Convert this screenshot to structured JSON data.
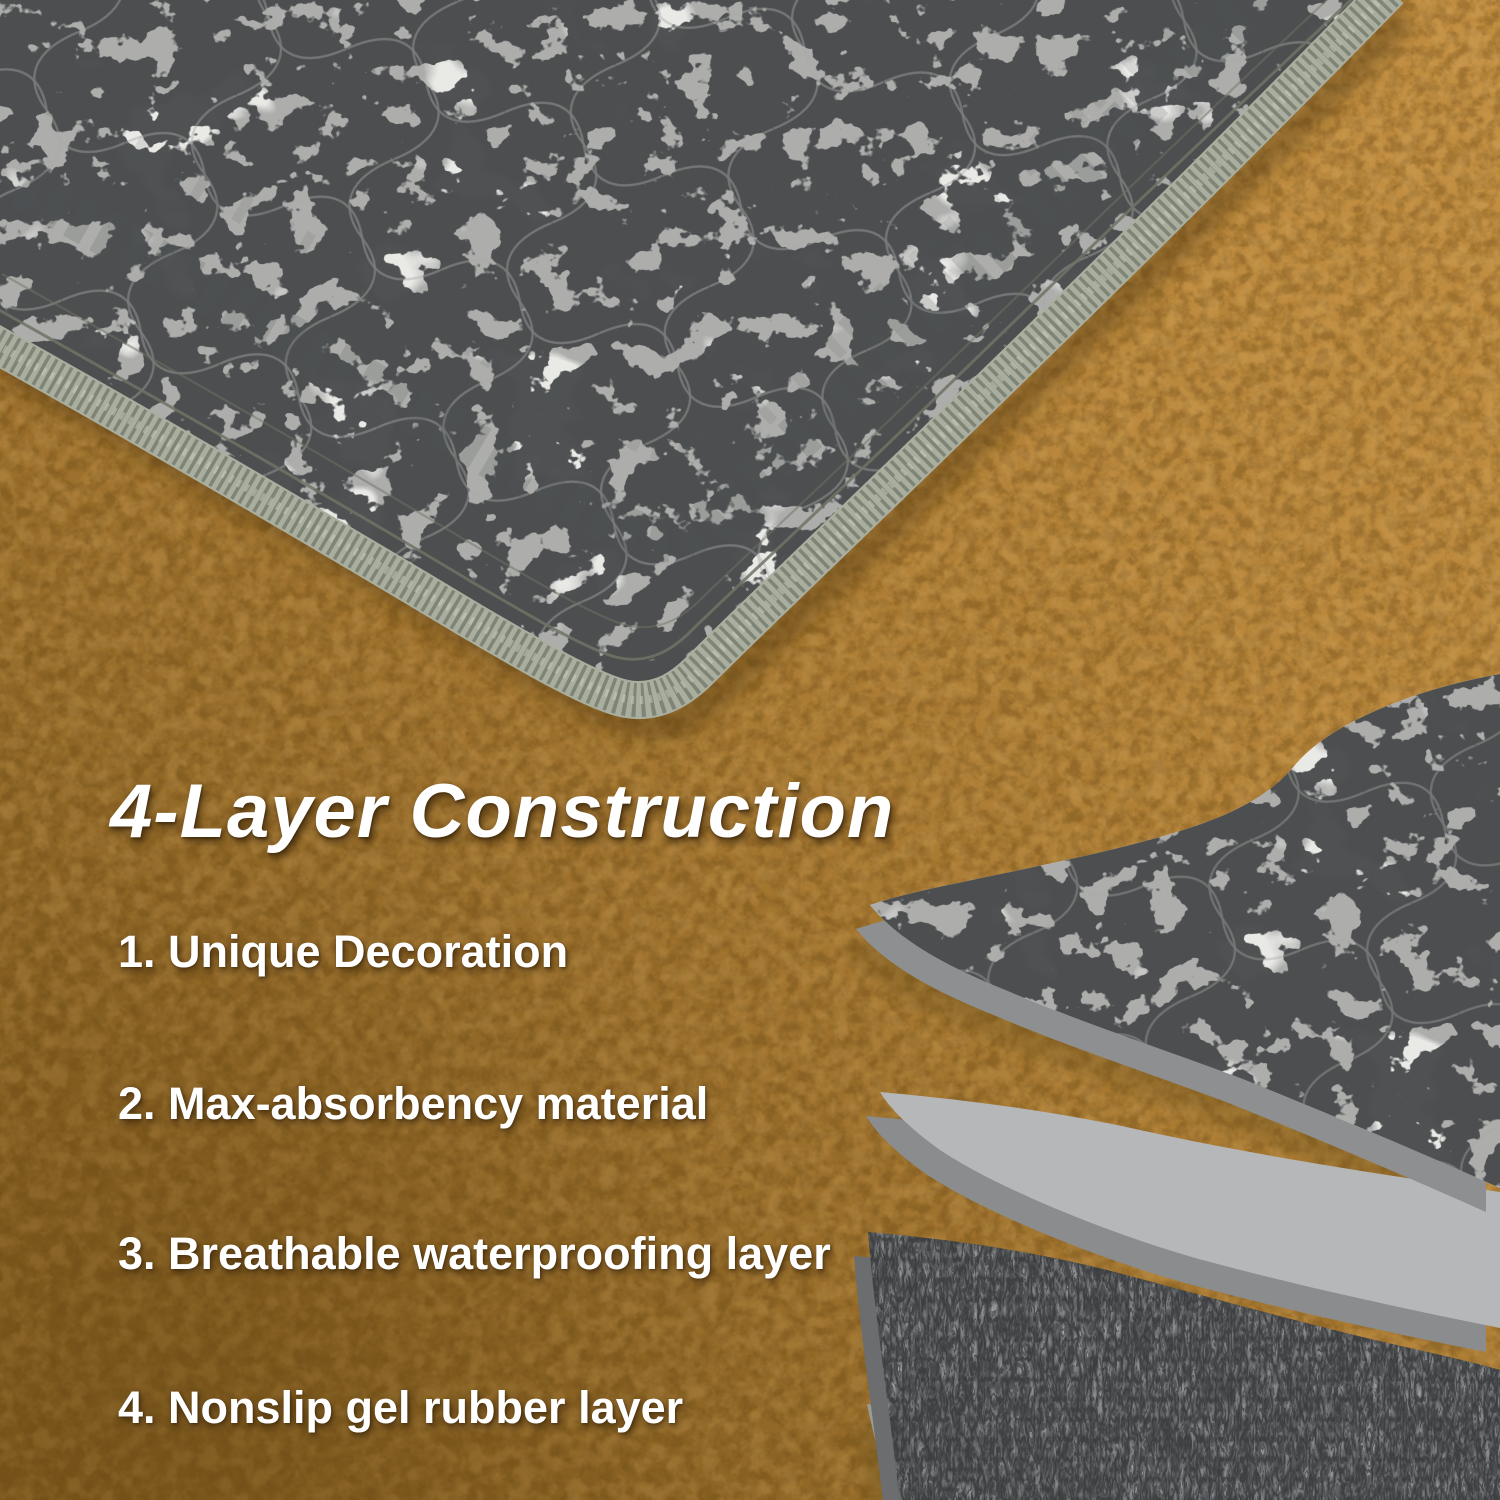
{
  "overlay": {
    "title": "4-Layer Construction",
    "items": [
      "1. Unique Decoration",
      "2. Max-absorbency material",
      "3. Breathable waterproofing layer",
      "4. Nonslip gel rubber layer"
    ]
  },
  "palette": {
    "floor_light": "#c49043",
    "floor_mid": "#ae7e35",
    "floor_dark": "#7f5a1e",
    "fabric_base": "#e9e9e6",
    "fabric_mid": "#a8a9a7",
    "fabric_dark": "#47494c",
    "serge": "#a9ae9f",
    "serge_dark": "#6e7365",
    "stitch": "#6f7365",
    "layer_thickness": "#8d8f91",
    "absorbent": "#b5b7b9",
    "waterproof": "#3a3c3e",
    "waterproof_edge": "#6b6d6f",
    "nonslip": "#c6c8c2",
    "nonslip_dot": "#b0b2ac",
    "nonslip_rim": "#efeee6",
    "text_color": "#ffffff"
  }
}
